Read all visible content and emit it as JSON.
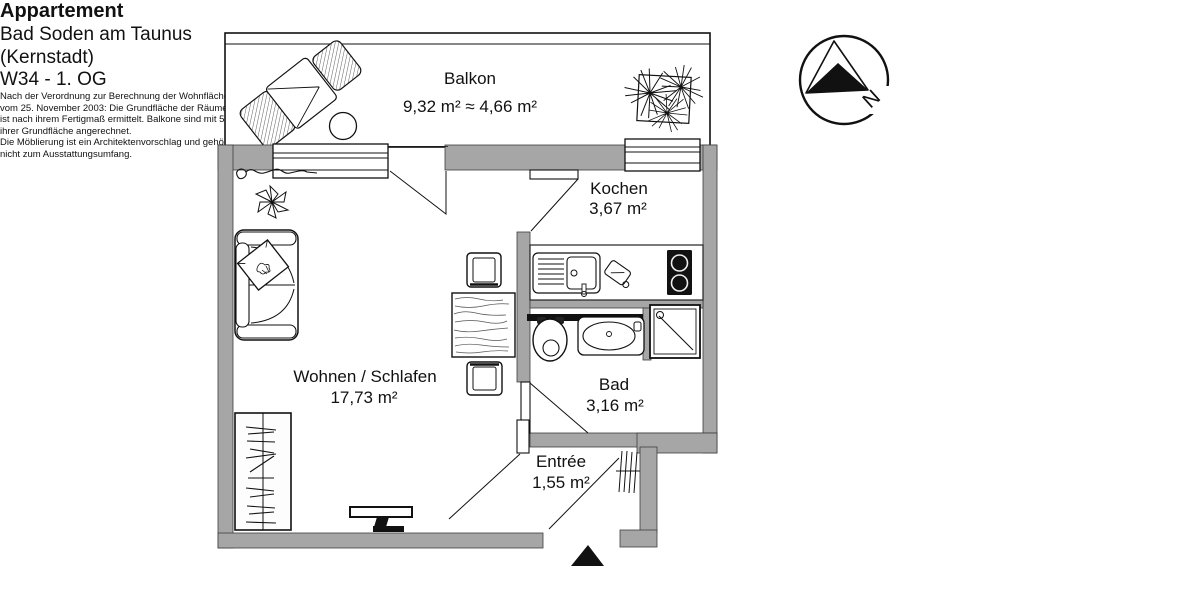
{
  "info": {
    "title": "Appartement",
    "location_line1": "Bad Soden am Taunus",
    "location_line2": "(Kernstadt)",
    "unit": "W34 - 1. OG",
    "note1": [
      "Nach der Verordnung zur Berechnung der Wohnfläche",
      "vom 25. November 2003: Die Grundfläche der Räume",
      "ist nach ihrem Fertigmaß ermittelt. Balkone sind mit 50%",
      "ihrer Grundfläche angerechnet."
    ],
    "note2": [
      "Die Möblierung ist ein Architektenvorschlag und gehört",
      "nicht zum Ausstattungsumfang."
    ]
  },
  "compass": {
    "north_label": "N"
  },
  "rooms": {
    "balcony": {
      "label": "Balkon",
      "area": "9,32 m² ≈ 4,66 m²"
    },
    "living": {
      "label": "Wohnen / Schlafen",
      "area": "17,73 m²"
    },
    "kitchen": {
      "label": "Kochen",
      "area": "3,67 m²"
    },
    "bath": {
      "label": "Bad",
      "area": "3,16 m²"
    },
    "entry": {
      "label": "Entrée",
      "area": "1,55 m²"
    }
  },
  "colors": {
    "wall": "#a6a6a6",
    "line": "#111111",
    "fixture_dark": "#111111"
  }
}
